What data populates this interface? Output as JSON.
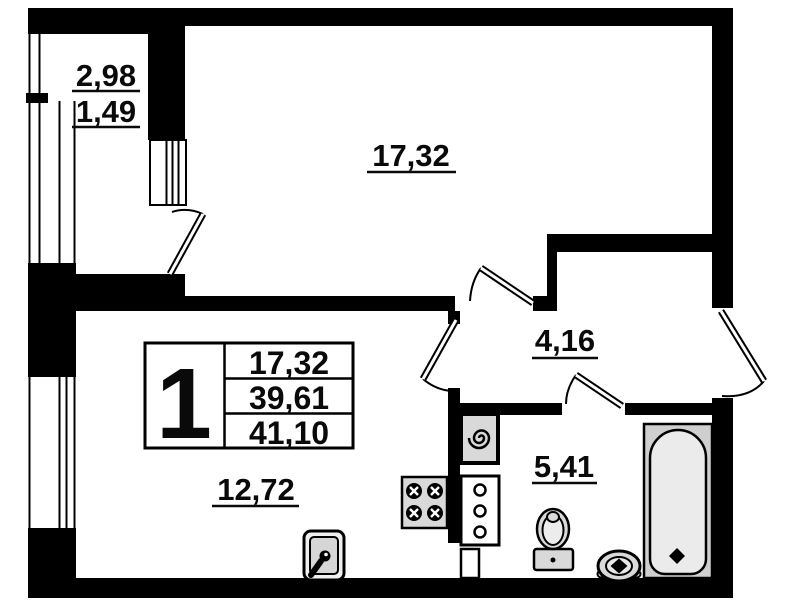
{
  "floor_plan": {
    "unit_summary": {
      "rooms_count": "1",
      "living_area": "17,32",
      "area_without_balcony": "39,61",
      "total_area": "41,10"
    },
    "room_areas": {
      "living_room": "17,32",
      "kitchen": "12,72",
      "hallway": "4,16",
      "bathroom": "5,41",
      "balcony_full": "2,98",
      "balcony_reduced": "1,49"
    },
    "colors": {
      "walls": "#000000",
      "background": "#ffffff",
      "fixture_fill": "#d9d9d9"
    },
    "icons": [
      "bathtub-icon",
      "toilet-icon",
      "washbasin-icon",
      "washing-machine-icon",
      "stove-icon",
      "kitchen-sink-icon",
      "cabinet-icon",
      "vent-duct-icon"
    ]
  }
}
